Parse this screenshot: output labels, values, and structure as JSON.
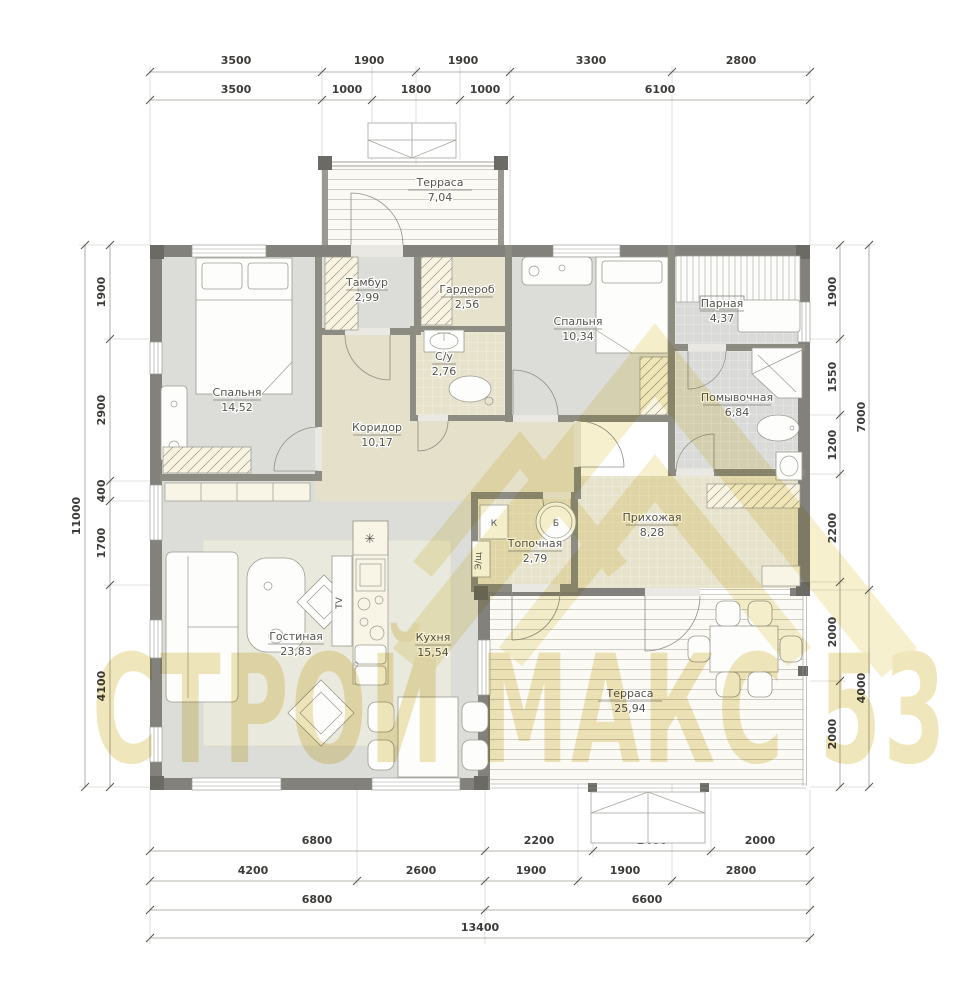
{
  "watermark": {
    "text": "СТРОЙ МАКС 53",
    "text_color": "#dcc45e",
    "roof_color": "#eee3ae"
  },
  "rooms": {
    "terrace_top": {
      "name": "Терраса",
      "area": "7,04"
    },
    "tambour": {
      "name": "Тамбур",
      "area": "2,99"
    },
    "wardrobe": {
      "name": "Гардероб",
      "area": "2,56"
    },
    "bedroom_small": {
      "name": "Спальня",
      "area": "10,34"
    },
    "sauna": {
      "name": "Парная",
      "area": "4,37"
    },
    "bedroom_main": {
      "name": "Спальня",
      "area": "14,52"
    },
    "bathroom": {
      "name": "С/у",
      "area": "2,76"
    },
    "corridor": {
      "name": "Коридор",
      "area": "10,17"
    },
    "washroom": {
      "name": "Помывочная",
      "area": "6,84"
    },
    "hallway": {
      "name": "Прихожая",
      "area": "8,28"
    },
    "boiler_room": {
      "name": "Топочная",
      "area": "2,79"
    },
    "living_room": {
      "name": "Гостиная",
      "area": "23,83"
    },
    "kitchen": {
      "name": "Кухня",
      "area": "15,54"
    },
    "terrace_main": {
      "name": "Терраса",
      "area": "25,94"
    }
  },
  "labels": {
    "boiler_k": "К",
    "boiler_b": "Б",
    "electrical": "Э/щ",
    "tv": "TV",
    "fridge": "✳"
  },
  "dims": {
    "top1": [
      "3500",
      "1900",
      "1900",
      "3300",
      "2800"
    ],
    "top2": [
      "3500",
      "1000",
      "1800",
      "1000",
      "6100"
    ],
    "left_total": "11000",
    "left": [
      "1900",
      "2900",
      "400",
      "1700",
      "4100"
    ],
    "right": [
      "1900",
      "1550",
      "1200",
      "2200",
      "2000",
      "2000"
    ],
    "right_outer": [
      "7000",
      "4000"
    ],
    "bottom1": [
      "6800",
      "2200",
      "2400",
      "2000"
    ],
    "bottom2": [
      "4200",
      "2600",
      "1900",
      "1900",
      "2800"
    ],
    "bottom3": [
      "6800",
      "6600"
    ],
    "bottom_total": "13400"
  },
  "colors": {
    "wall": "#82817b",
    "floor_gray": "#dcddd9",
    "floor_tan": "#e4e0c9",
    "tile_gray": "#dadbd8",
    "terrace": "#fbfaf5",
    "watermark": "#e8d67f"
  }
}
